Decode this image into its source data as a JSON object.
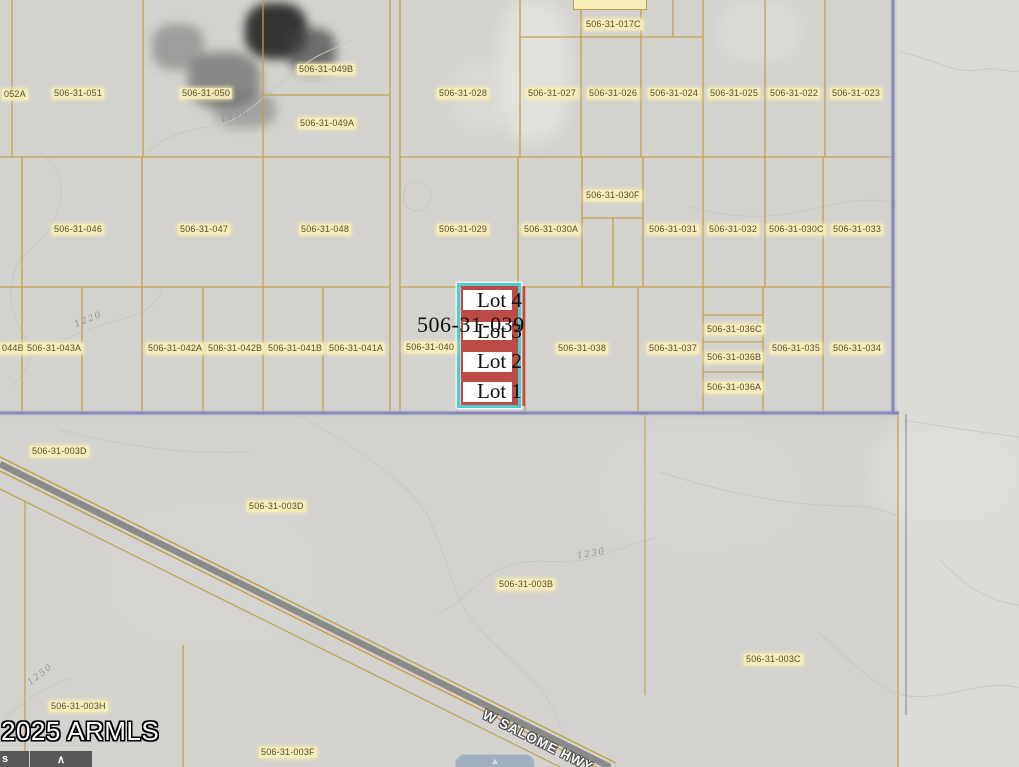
{
  "map": {
    "watermark": "2025 ARMLS",
    "road_label": "W SALOME HWY",
    "selected_parcel": {
      "apn": "506-31-039",
      "lots": [
        "Lot 4",
        "Lot 3",
        "Lot 2",
        "Lot 1"
      ],
      "highlight_fill": "#bc4b46",
      "highlight_border": "#4bcdd2"
    },
    "colors": {
      "background": "#d3d2ce",
      "parcel_line": "#c2a046",
      "section_line": "#8687b2",
      "label_background": "#f8eeb6",
      "label_text": "#564e38",
      "road_fill": "#8a8a88"
    },
    "parcel_labels": [
      {
        "text": "052A",
        "x": 2,
        "y": 89
      },
      {
        "text": "506-31-051",
        "x": 52,
        "y": 88
      },
      {
        "text": "506-31-050",
        "x": 180,
        "y": 88
      },
      {
        "text": "506-31-049B",
        "x": 297,
        "y": 64
      },
      {
        "text": "506-31-049A",
        "x": 298,
        "y": 118
      },
      {
        "text": "506-31-017C",
        "x": 584,
        "y": 19
      },
      {
        "text": "506-31-028",
        "x": 437,
        "y": 88
      },
      {
        "text": "506-31-027",
        "x": 526,
        "y": 88
      },
      {
        "text": "506-31-026",
        "x": 587,
        "y": 88
      },
      {
        "text": "506-31-024",
        "x": 648,
        "y": 88
      },
      {
        "text": "506-31-025",
        "x": 708,
        "y": 88
      },
      {
        "text": "506-31-022",
        "x": 768,
        "y": 88
      },
      {
        "text": "506-31-023",
        "x": 830,
        "y": 88
      },
      {
        "text": "506-31-046",
        "x": 52,
        "y": 224
      },
      {
        "text": "506-31-047",
        "x": 178,
        "y": 224
      },
      {
        "text": "506-31-048",
        "x": 299,
        "y": 224
      },
      {
        "text": "506-31-029",
        "x": 437,
        "y": 224
      },
      {
        "text": "506-31-030A",
        "x": 522,
        "y": 224
      },
      {
        "text": "506-31-030F",
        "x": 584,
        "y": 190
      },
      {
        "text": "506-31-031",
        "x": 647,
        "y": 224
      },
      {
        "text": "506-31-032",
        "x": 707,
        "y": 224
      },
      {
        "text": "506-31-030C",
        "x": 767,
        "y": 224
      },
      {
        "text": "506-31-033",
        "x": 831,
        "y": 224
      },
      {
        "text": "044B",
        "x": 0,
        "y": 343
      },
      {
        "text": "506-31-043A",
        "x": 25,
        "y": 343
      },
      {
        "text": "506-31-042A",
        "x": 146,
        "y": 343
      },
      {
        "text": "506-31-042B",
        "x": 206,
        "y": 343
      },
      {
        "text": "506-31-041B",
        "x": 266,
        "y": 343
      },
      {
        "text": "506-31-041A",
        "x": 327,
        "y": 343
      },
      {
        "text": "506-31-040",
        "x": 404,
        "y": 342
      },
      {
        "text": "506-31-038",
        "x": 556,
        "y": 343
      },
      {
        "text": "506-31-037",
        "x": 647,
        "y": 343
      },
      {
        "text": "506-31-036C",
        "x": 705,
        "y": 324
      },
      {
        "text": "506-31-036B",
        "x": 705,
        "y": 352
      },
      {
        "text": "506-31-036A",
        "x": 705,
        "y": 382
      },
      {
        "text": "506-31-035",
        "x": 770,
        "y": 343
      },
      {
        "text": "506-31-034",
        "x": 831,
        "y": 343
      },
      {
        "text": "506-31-003D",
        "x": 30,
        "y": 446
      },
      {
        "text": "506-31-003D",
        "x": 247,
        "y": 501
      },
      {
        "text": "506-31-003B",
        "x": 497,
        "y": 579
      },
      {
        "text": "506-31-003C",
        "x": 744,
        "y": 654
      },
      {
        "text": "506-31-003H",
        "x": 49,
        "y": 701
      },
      {
        "text": "506-31-003F",
        "x": 259,
        "y": 747
      }
    ],
    "contour_labels": [
      {
        "text": "1250",
        "x": 220,
        "y": 111,
        "angle": -18
      },
      {
        "text": "1220",
        "x": 74,
        "y": 315,
        "angle": -22
      },
      {
        "text": "1230",
        "x": 577,
        "y": 549,
        "angle": -10
      },
      {
        "text": "1250",
        "x": 26,
        "y": 670,
        "angle": -38
      }
    ]
  },
  "controls": {
    "partial_label": "s",
    "collapse_glyph": "∧",
    "map_button_glyph": "▲"
  }
}
